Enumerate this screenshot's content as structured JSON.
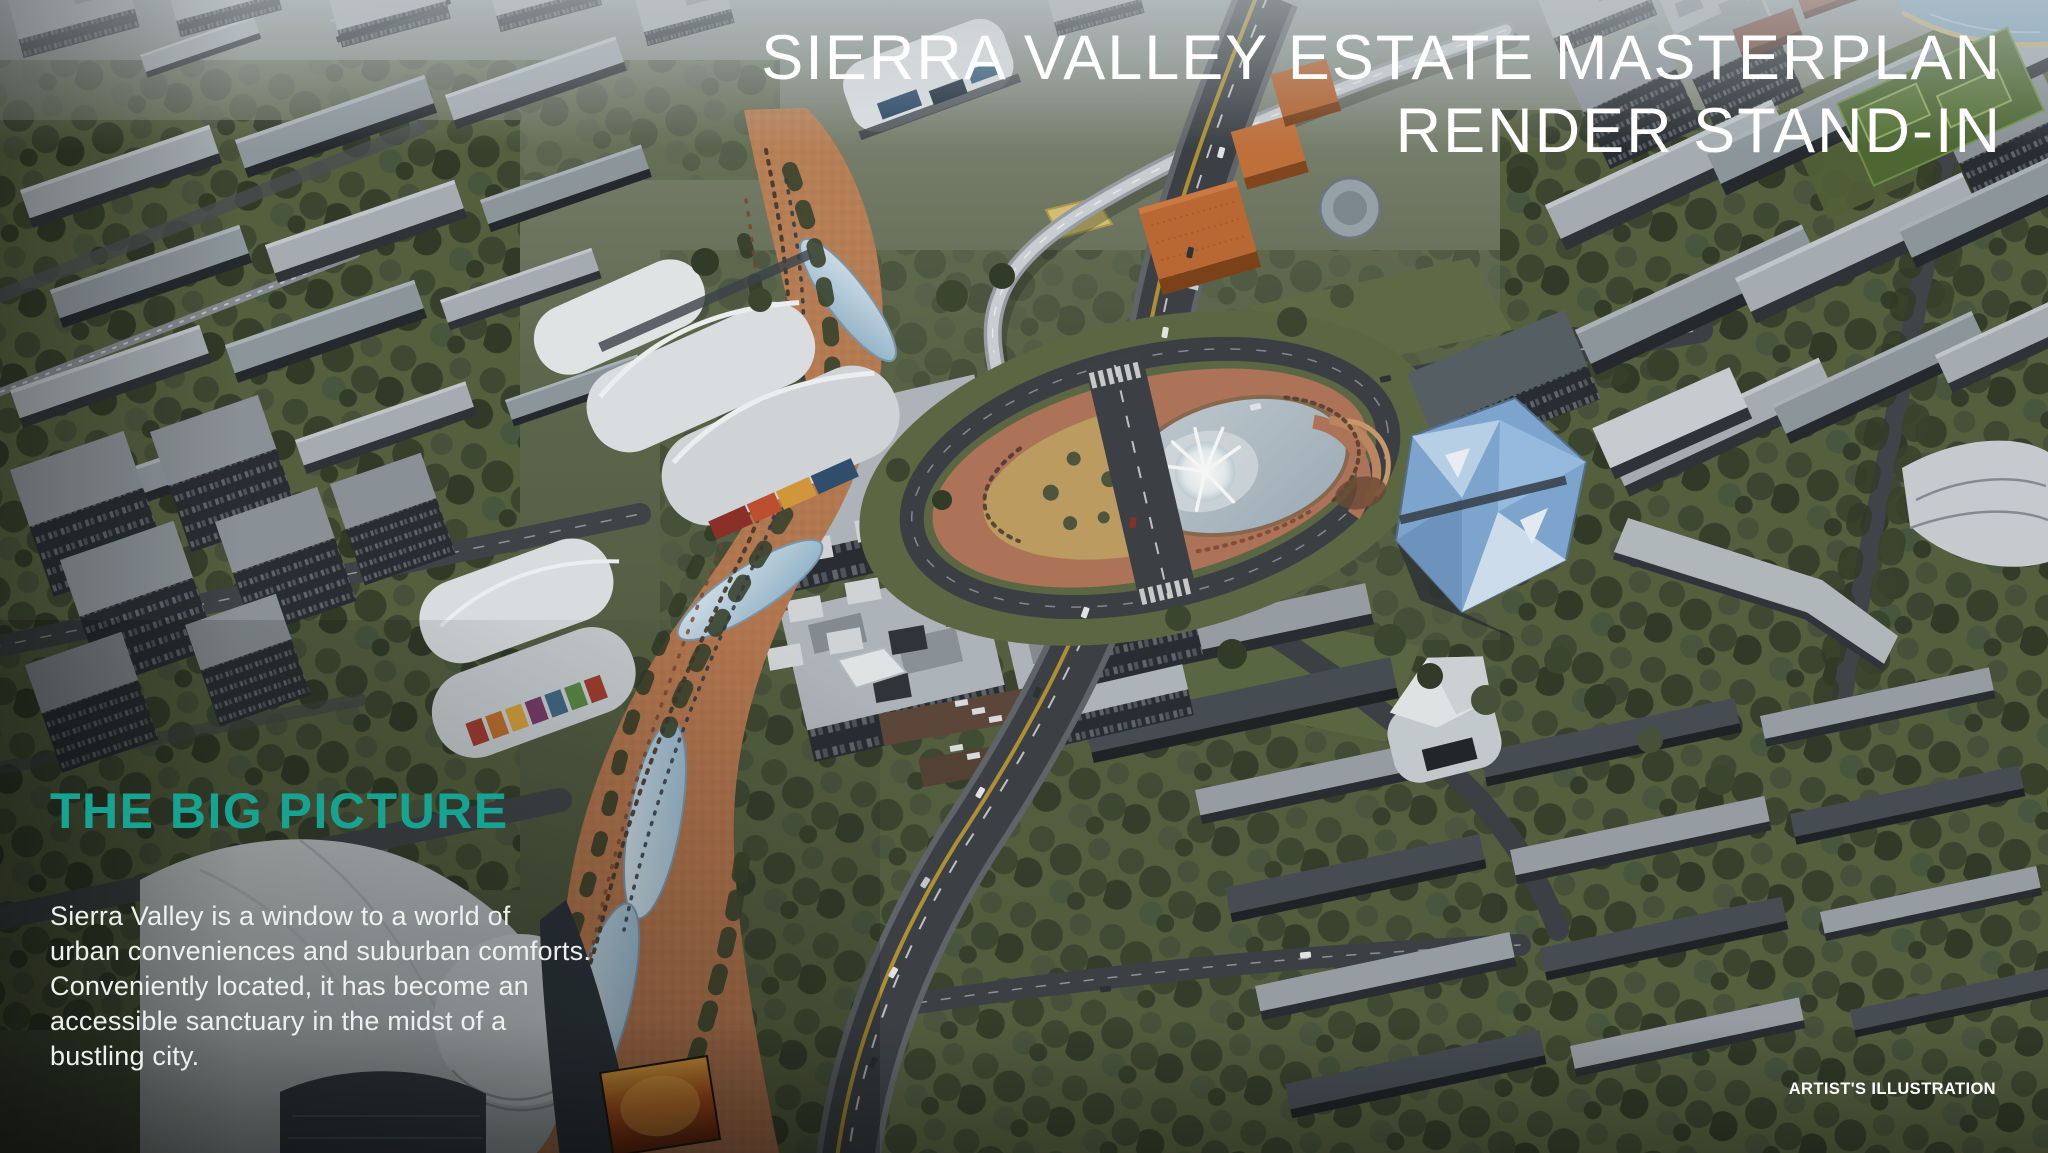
{
  "header": {
    "title_line_1": "SIERRA VALLEY ESTATE MASTERPLAN",
    "title_line_2": "RENDER STAND-IN"
  },
  "content": {
    "heading": "THE BIG PICTURE",
    "paragraph_lines": [
      "Sierra Valley is a window to a world of",
      "urban conveniences and suburban comforts.",
      "Conveniently located, it has become an",
      "accessible sanctuary in the midst of a",
      "bustling city."
    ]
  },
  "footer": {
    "caption": "ARTIST'S ILLUSTRATION"
  },
  "palette": {
    "heading_teal": "#16a392",
    "text_white": "#ffffff",
    "boulevard_brick": "#b5774f",
    "pond_blue": "#b6c2cb",
    "crystal_blue": "#7fa9d4",
    "orange_cube": "#bf6a33",
    "tree_green": "#3d4931",
    "asphalt": "#3b4046"
  }
}
